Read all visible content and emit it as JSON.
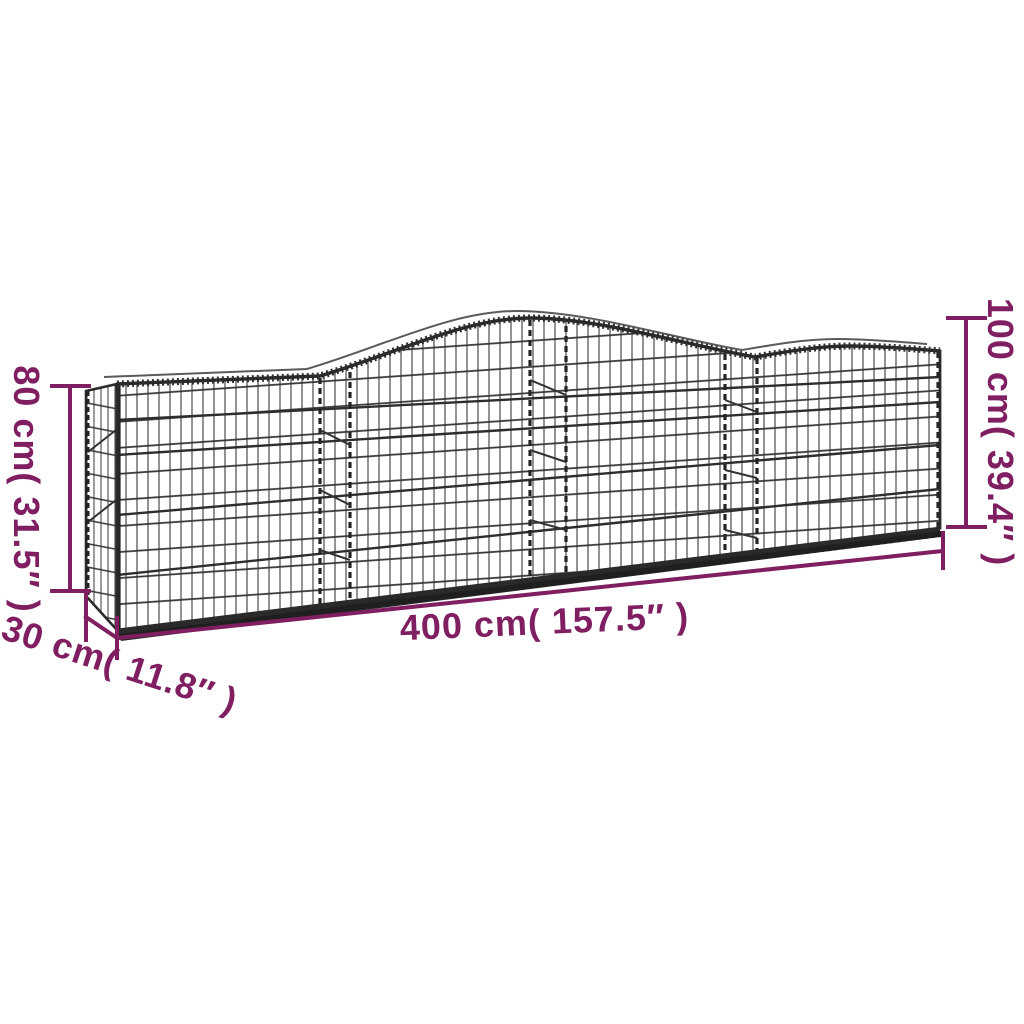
{
  "diagram": {
    "type": "product-dimension-diagram",
    "subject": "arched gabion wire mesh basket",
    "background_color": "#ffffff",
    "accent_color": "#801e62",
    "wire_color": "#2b2b2b",
    "dimensions": {
      "height_left": {
        "label": "80 cm( 31.5″ )",
        "value_cm": 80,
        "value_inch": 31.5
      },
      "height_right": {
        "label": "100 cm( 39.4″ )",
        "value_cm": 100,
        "value_inch": 39.4
      },
      "length": {
        "label": "400 cm( 157.5″ )",
        "value_cm": 400,
        "value_inch": 157.5
      },
      "depth": {
        "label": "30 cm( 11.8″ )",
        "value_cm": 30,
        "value_inch": 11.8
      }
    }
  }
}
